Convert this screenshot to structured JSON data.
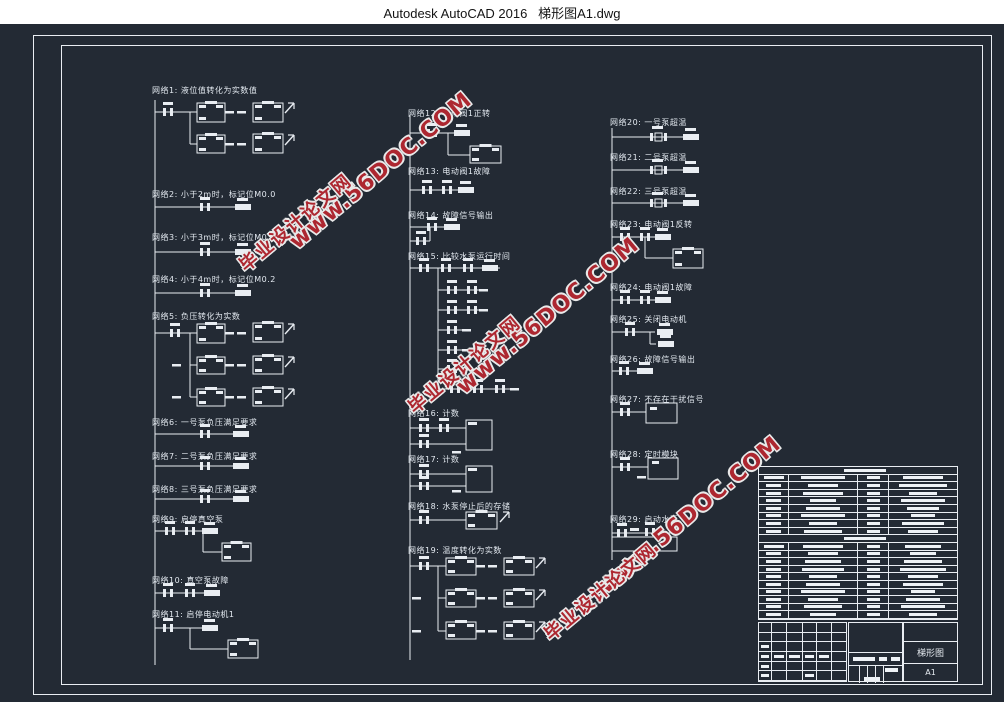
{
  "window": {
    "title": "Autodesk AutoCAD 2016   梯形图A1.dwg"
  },
  "canvas": {
    "background": "#232a34",
    "line_color": "#e9edf2"
  },
  "watermark": {
    "site": "www.56DOC.COM",
    "site_cn": "毕业设计论文网",
    "color": "#ad2730"
  },
  "networks": [
    {
      "id": 1,
      "label": "网络1: 液位值转化为实数值"
    },
    {
      "id": 2,
      "label": "网络2: 小于2m时，标记位M0.0"
    },
    {
      "id": 3,
      "label": "网络3: 小于3m时，标记位M0.1"
    },
    {
      "id": 4,
      "label": "网络4: 小于4m时，标记位M0.2"
    },
    {
      "id": 5,
      "label": "网络5: 负压转化为实数"
    },
    {
      "id": 6,
      "label": "网络6: 一号泵负压满足要求"
    },
    {
      "id": 7,
      "label": "网络7: 二号泵负压满足要求"
    },
    {
      "id": 8,
      "label": "网络8: 三号泵负压满足要求"
    },
    {
      "id": 9,
      "label": "网络9: 启停真空泵"
    },
    {
      "id": 10,
      "label": "网络10: 真空泵故障"
    },
    {
      "id": 11,
      "label": "网络11: 启停电动机1"
    },
    {
      "id": 12,
      "label": "网络12: 电动阀1正转"
    },
    {
      "id": 13,
      "label": "网络13: 电动阀1故障"
    },
    {
      "id": 14,
      "label": "网络14: 故障信号输出"
    },
    {
      "id": 15,
      "label": "网络15: 比较水泵运行时间"
    },
    {
      "id": 16,
      "label": "网络16: 计数"
    },
    {
      "id": 17,
      "label": "网络17: 计数"
    },
    {
      "id": 18,
      "label": "网络18: 水泵停止后的存储"
    },
    {
      "id": 19,
      "label": "网络19: 温度转化为实数"
    },
    {
      "id": 20,
      "label": "网络20: 一号泵超温"
    },
    {
      "id": 21,
      "label": "网络21: 二号泵超温"
    },
    {
      "id": 22,
      "label": "网络22: 三号泵超温"
    },
    {
      "id": 23,
      "label": "网络23: 电动阀1反转"
    },
    {
      "id": 24,
      "label": "网络24: 电动阀1故障"
    },
    {
      "id": 25,
      "label": "网络25: 关闭电动机"
    },
    {
      "id": 26,
      "label": "网络26: 故障信号输出"
    },
    {
      "id": 27,
      "label": "网络27: 不存在干扰信号"
    },
    {
      "id": 28,
      "label": "网络28: 定时模块"
    },
    {
      "id": 29,
      "label": "网络29: 启动水泵"
    }
  ],
  "title_block": {
    "drawing_name": "梯形图",
    "sheet": "A1"
  }
}
